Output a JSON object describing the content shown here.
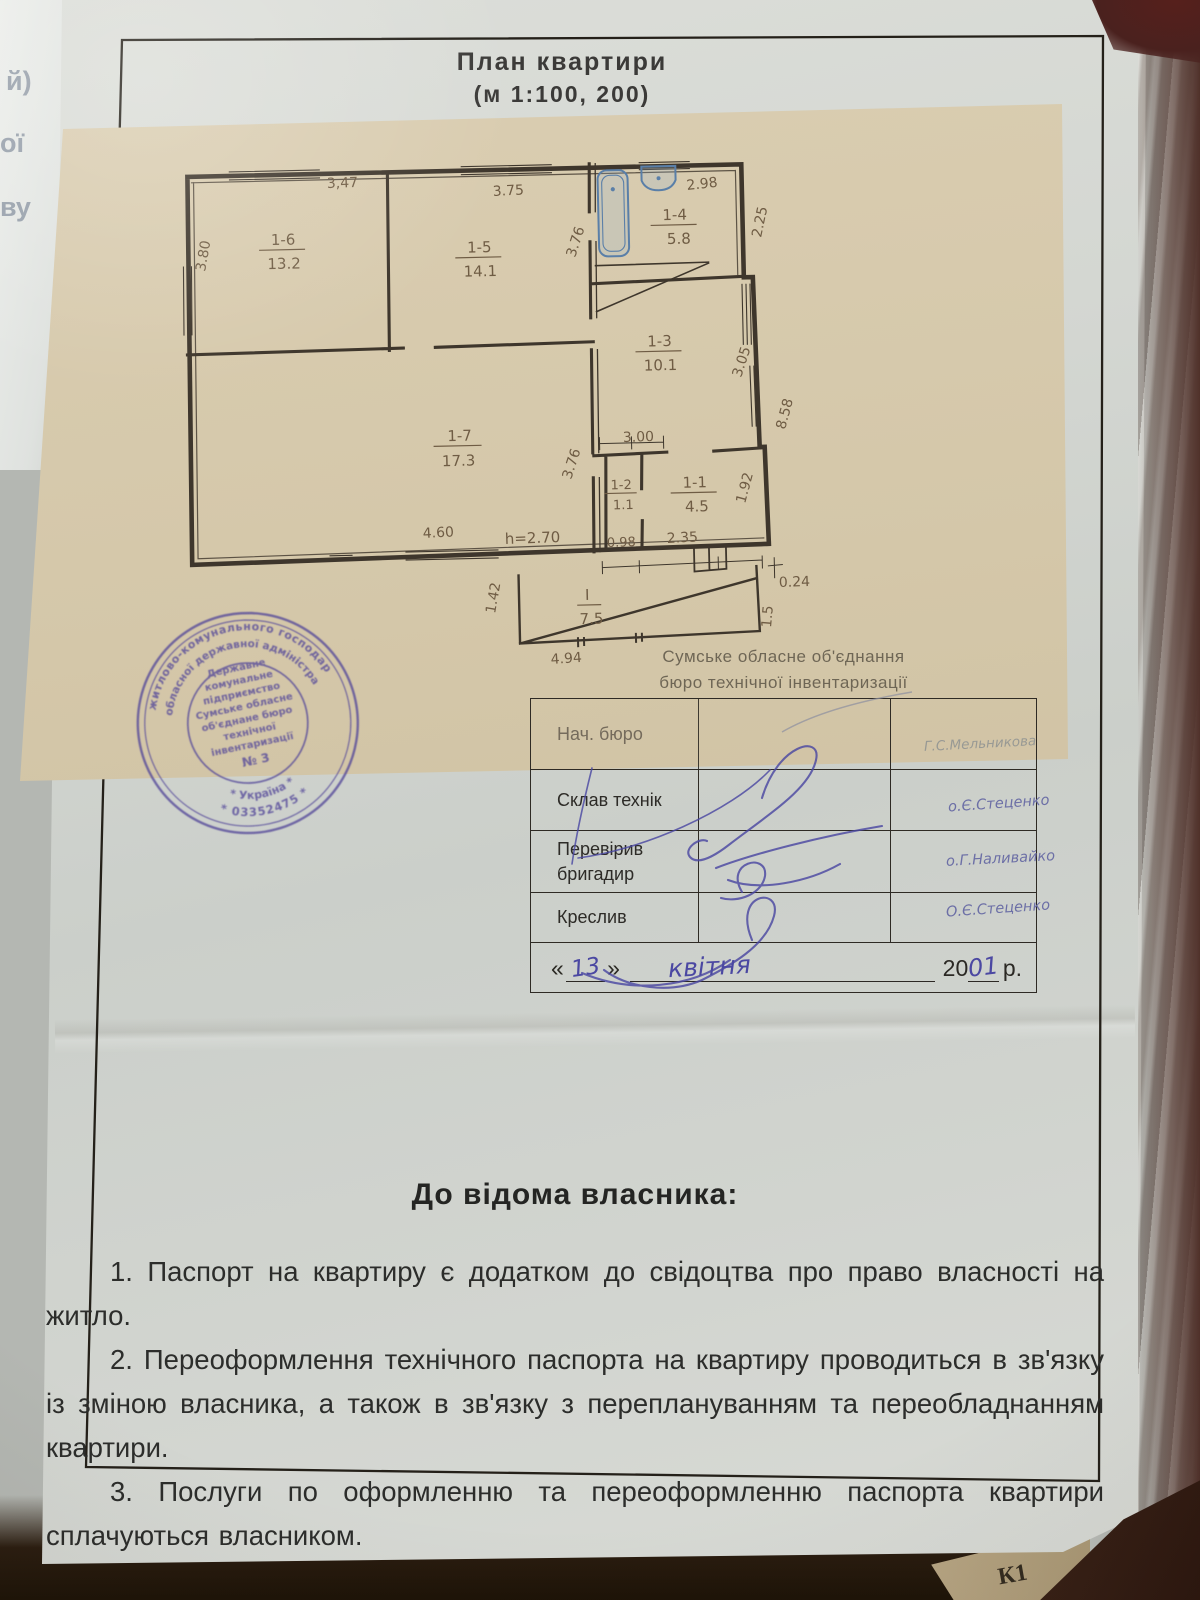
{
  "photo": {
    "underlay_left_letters": [
      "й)",
      "ої",
      "ву"
    ],
    "underlay_corner_text": "К1"
  },
  "colors": {
    "plan_ink": "#3e362c",
    "hand_ink": "#6f5c44",
    "stamp_ink": "#54489a",
    "pen_blue": "#4b48a2",
    "fixture_blue": "#5a7fa8",
    "tracing_paper": "#d2c4a6"
  },
  "title": {
    "line1": "План квартири",
    "line2": "(м 1:100,  200)"
  },
  "plan": {
    "rooms": [
      {
        "id": "1-6",
        "area": "13.2"
      },
      {
        "id": "1-5",
        "area": "14.1"
      },
      {
        "id": "1-4",
        "area": "5.8"
      },
      {
        "id": "1-3",
        "area": "10.1"
      },
      {
        "id": "1-7",
        "area": "17.3"
      },
      {
        "id": "1-2",
        "area": "1.1"
      },
      {
        "id": "1-1",
        "area": "4.5"
      }
    ],
    "porch": {
      "id": "І",
      "area": "7.5"
    },
    "height_note": "h=2.70",
    "dims": {
      "d347": "3,47",
      "d375": "3.75",
      "d298": "2.98",
      "d380": "3.80",
      "d376a": "3.76",
      "d225": "2.25",
      "d305": "3.05",
      "d858": "8.58",
      "d300": "3.00",
      "d376b": "3.76",
      "d192": "1.92",
      "d460": "4.60",
      "d098": "0.98",
      "d235": "2.35",
      "d024": "0.24",
      "d142": "1.42",
      "d15": "1.5",
      "d494": "4.94"
    }
  },
  "org": {
    "line1": "Сумське обласне об'єднання",
    "line2": "бюро технічної інвентаризації"
  },
  "table": {
    "rows": [
      {
        "label": "Нач. бюро",
        "label2": "",
        "name": "Г.С.Мельникова"
      },
      {
        "label": "Склав технік",
        "label2": "",
        "name": "о.Є.Стеценко"
      },
      {
        "label": "Перевірив",
        "label2": "бригадир",
        "name": "о.Г.Наливайко"
      },
      {
        "label": "Креслив",
        "label2": "",
        "name": "О.Є.Стеценко"
      }
    ],
    "date": {
      "open": "«",
      "day": "13",
      "close": "»",
      "month": "квітня",
      "century": "20",
      "year": "01",
      "suffix": "р."
    }
  },
  "stamp": {
    "ring_top_outer": "ння житлово-комунального господарства",
    "ring_top_inner": "ої обласної державної адміністрації",
    "ring_bottom_outer": "* 03352475 *",
    "ring_bottom_inner": "* Україна *",
    "center_lines": [
      "Державне",
      "комунальне",
      "підприємство",
      "Сумське обласне",
      "об'єднане бюро",
      "технічної",
      "інвентаризації",
      "№ 3"
    ]
  },
  "notice": {
    "heading": "До відома власника:",
    "items": [
      "1. Паспорт на квартиру є додатком до свідоцтва про право власності на житло.",
      "2. Переоформлення технічного паспорта на квартиру проводиться в зв'язку із зміною власника, а також в зв'язку з переплануванням та переобладнанням квартири.",
      "3. Послуги по оформленню та переоформленню паспорта квартири сплачуються власником."
    ]
  }
}
